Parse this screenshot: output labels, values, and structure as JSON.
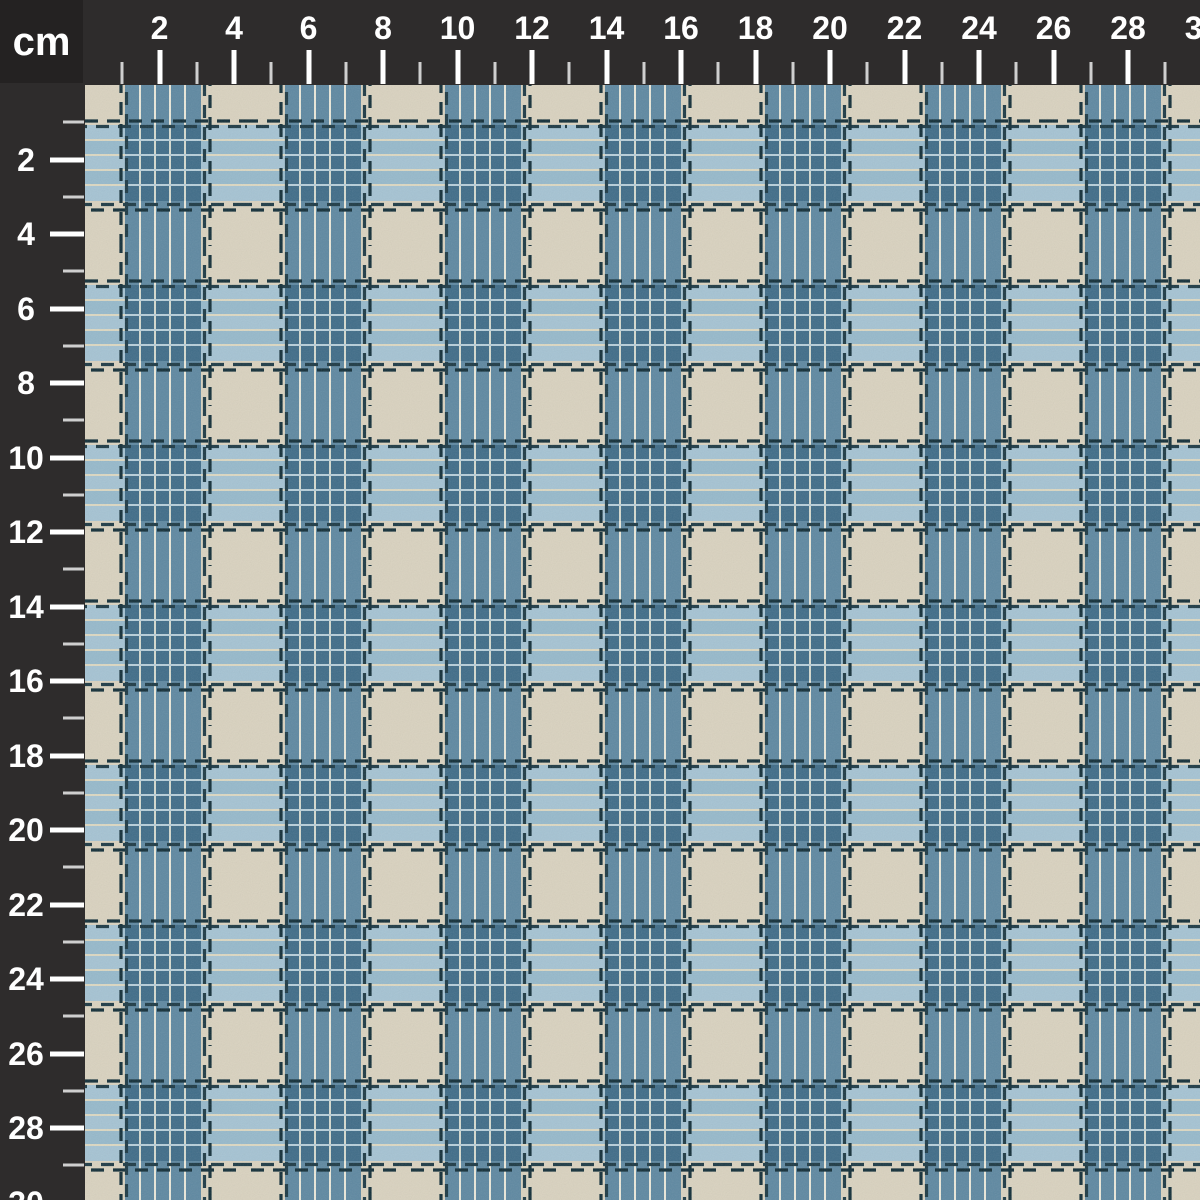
{
  "ruler": {
    "unit_label": "cm",
    "top_numbers": [
      2,
      4,
      6,
      8,
      10,
      12,
      14,
      16,
      18,
      20,
      22,
      24,
      26,
      28,
      30
    ],
    "left_numbers": [
      2,
      4,
      6,
      8,
      10,
      12,
      14,
      16,
      18,
      20,
      22,
      24,
      26,
      28,
      30
    ],
    "colors": {
      "ruler_bg": "#2e2c2c",
      "corner_bg": "#242222",
      "ruler_text": "#ffffff",
      "tick_major": "#ffffff",
      "tick_minor": "#cfcfcf"
    }
  },
  "fabric": {
    "colors": {
      "beige": "#d9d2bf",
      "band_light_blue": "#a5c3d3",
      "band_light_blue_alt": "#96b9cb",
      "pale_stripe": "#dcd8c2",
      "band_blue": "#5e88a1",
      "pinstripe": "#eae8da",
      "overlap_blue": "#3f6c88",
      "overlap_vline": "#d5dacf",
      "overlap_hline": "#b8cfda",
      "stitch_dark": "#122e38",
      "stitch_teal": "#1d3a45"
    }
  }
}
